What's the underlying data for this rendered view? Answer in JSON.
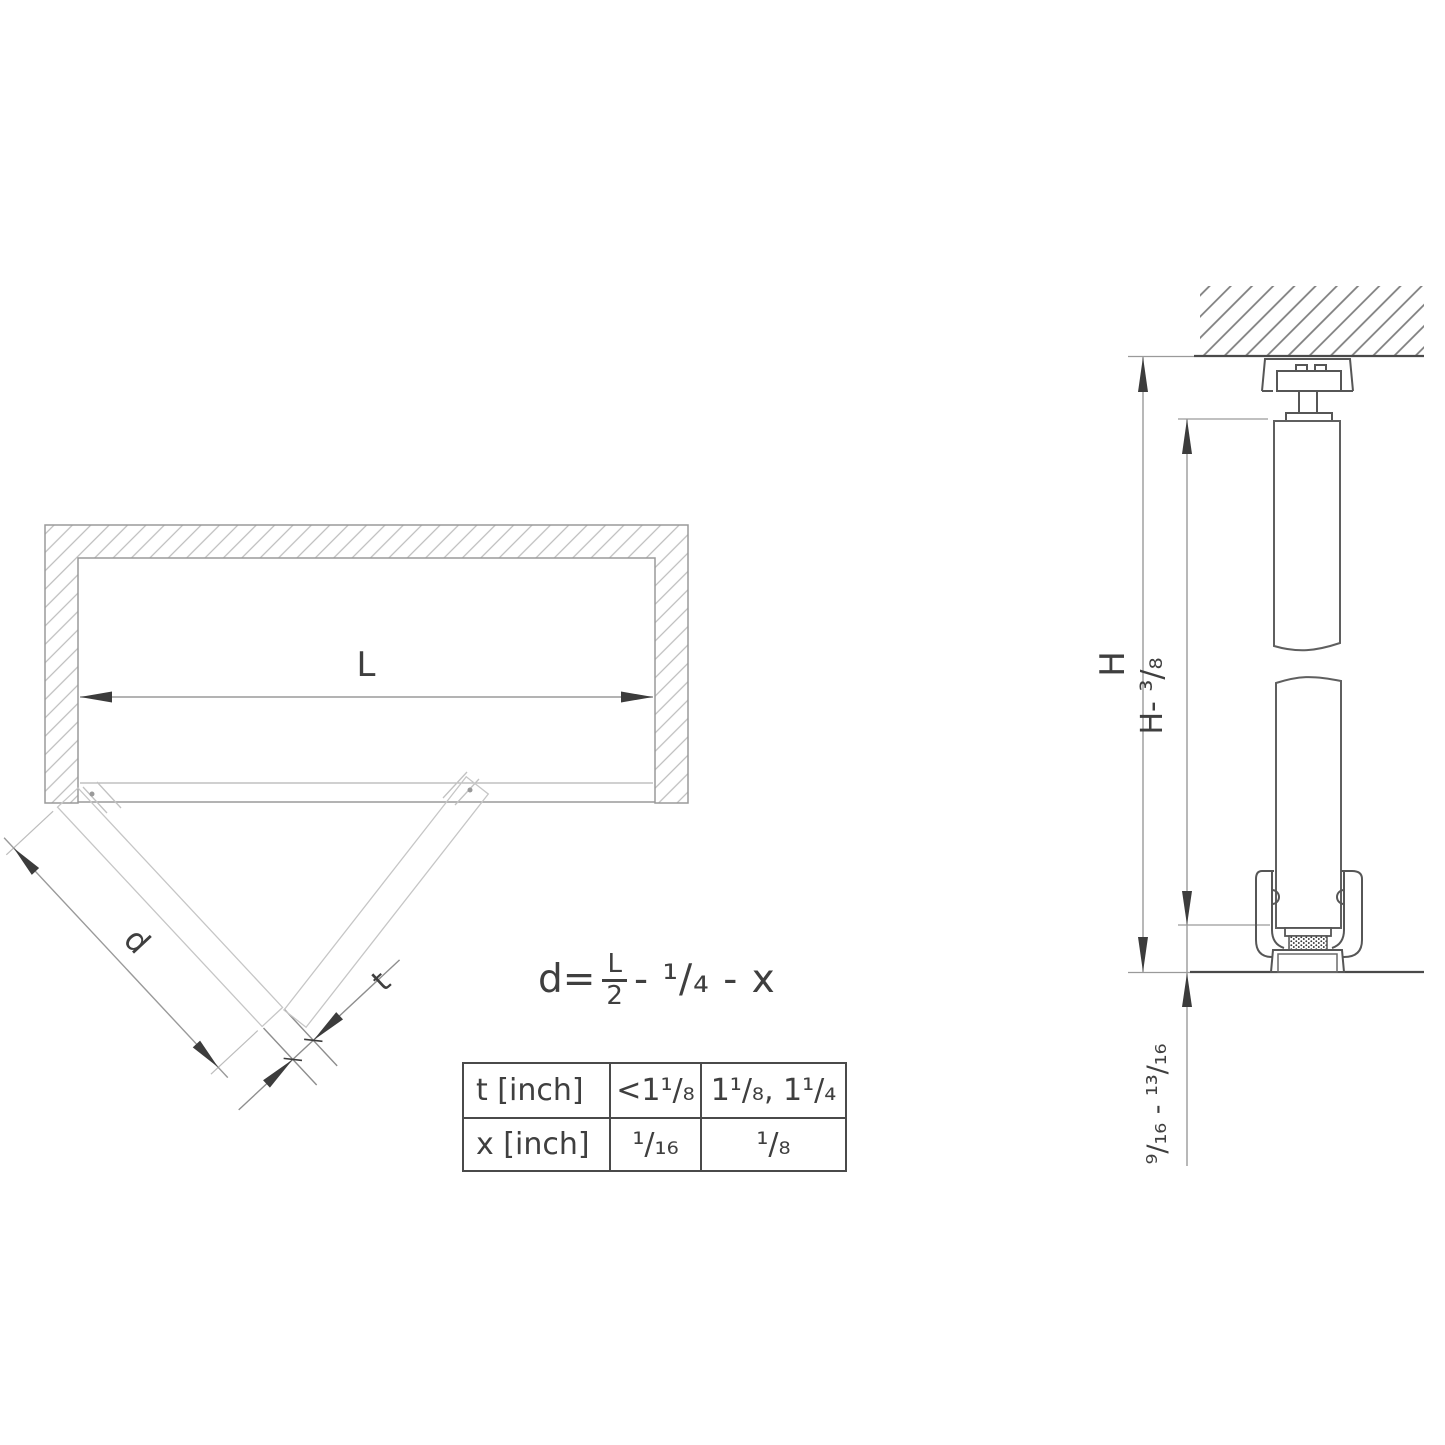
{
  "drawing": {
    "plan_view": {
      "opening_width_label": "L",
      "door_width_label": "d",
      "door_thickness_label": "t"
    },
    "section_view": {
      "total_height_label": "H",
      "door_height_label": "H- ³/₈",
      "floor_clearance_label": "⁹/₁₆ - ¹³/₁₆"
    },
    "formula": {
      "lhs": "d=",
      "fraction_numerator": "L",
      "fraction_denominator": "2",
      "tail": "- ¹/₄ - x"
    },
    "table": {
      "rows": [
        [
          "t [inch]",
          "<1¹/₈",
          "1¹/₈, 1¹/₄"
        ],
        [
          "x [inch]",
          "¹/₁₆",
          "¹/₈"
        ]
      ]
    },
    "colors": {
      "background": "#ffffff",
      "line_dark": "#4a4a4a",
      "line_medium": "#9a9a9a",
      "line_light": "#c6c6c6",
      "hatch_light": "#bdbdbd",
      "hatch_dark": "#7d7d7d",
      "text": "#3f3f3f",
      "arrow": "#3c3c3c"
    }
  }
}
